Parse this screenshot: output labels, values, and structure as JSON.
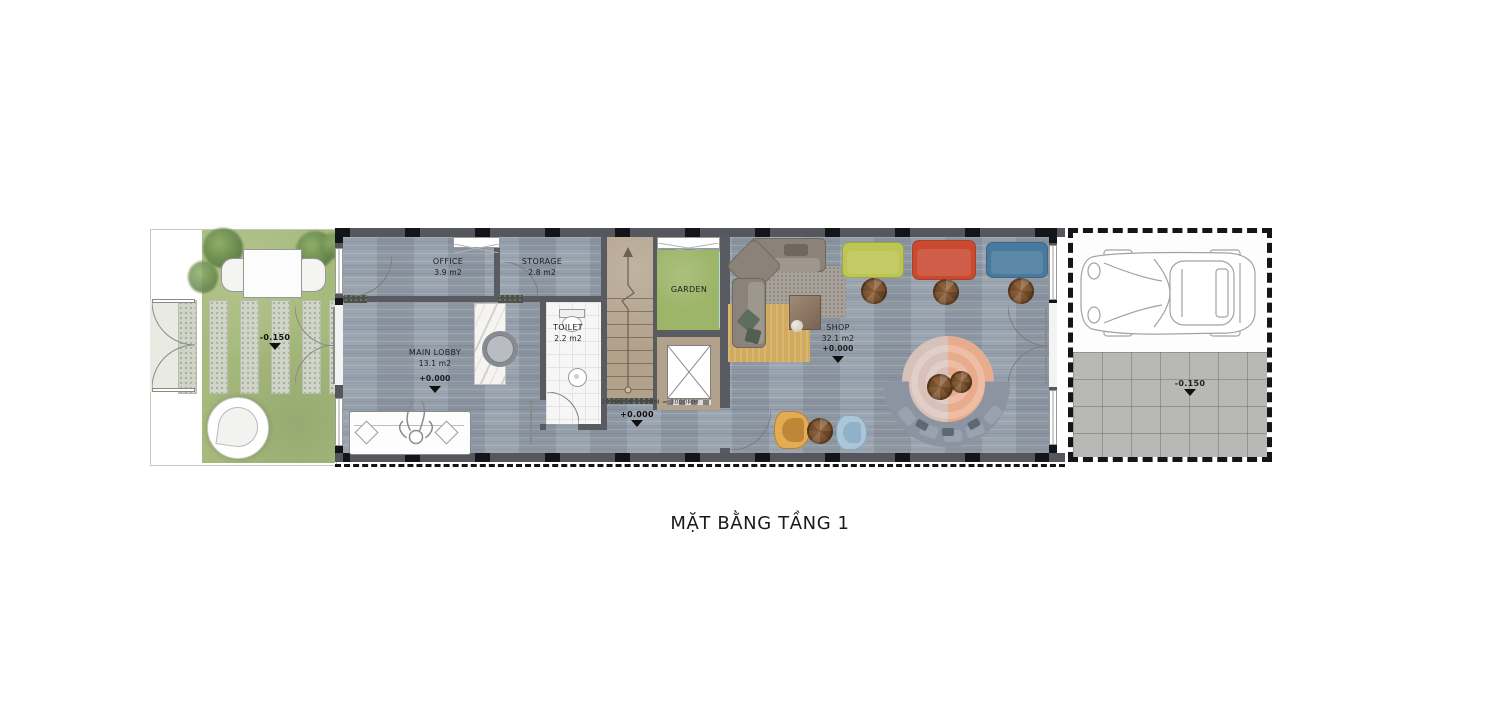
{
  "title": "MẶT BẰNG TẦNG 1",
  "rooms": {
    "office": {
      "name": "OFFICE",
      "area": "3.9 m2"
    },
    "storage": {
      "name": "STORAGE",
      "area": "2.8 m2"
    },
    "main_lobby": {
      "name": "MAIN LOBBY",
      "area": "13.1 m2",
      "level": "+0.000"
    },
    "toilet": {
      "name": "TOILET",
      "area": "2.2 m2"
    },
    "garden": {
      "name": "GARDEN"
    },
    "shop": {
      "name": "SHOP",
      "area": "32.1 m2",
      "level": "+0.000"
    }
  },
  "levels": {
    "front_yard": "-0.150",
    "corridor": "+0.000",
    "parking": "-0.150"
  },
  "stair_note": "20 BẬC X 150MM = 3000MM",
  "colors": {
    "floor_wood": "#96a0ac",
    "grass": "#a6ba7c",
    "wall": "#56575c",
    "stair": "#b2a28c",
    "sofa_lime": "#bdc554",
    "sofa_red": "#c94a31",
    "sofa_blue": "#487a9e",
    "rug_yellow": "#d2ab5f",
    "rug_round_peach": "#e8ab8d",
    "glazing": "#b5dbe4"
  }
}
